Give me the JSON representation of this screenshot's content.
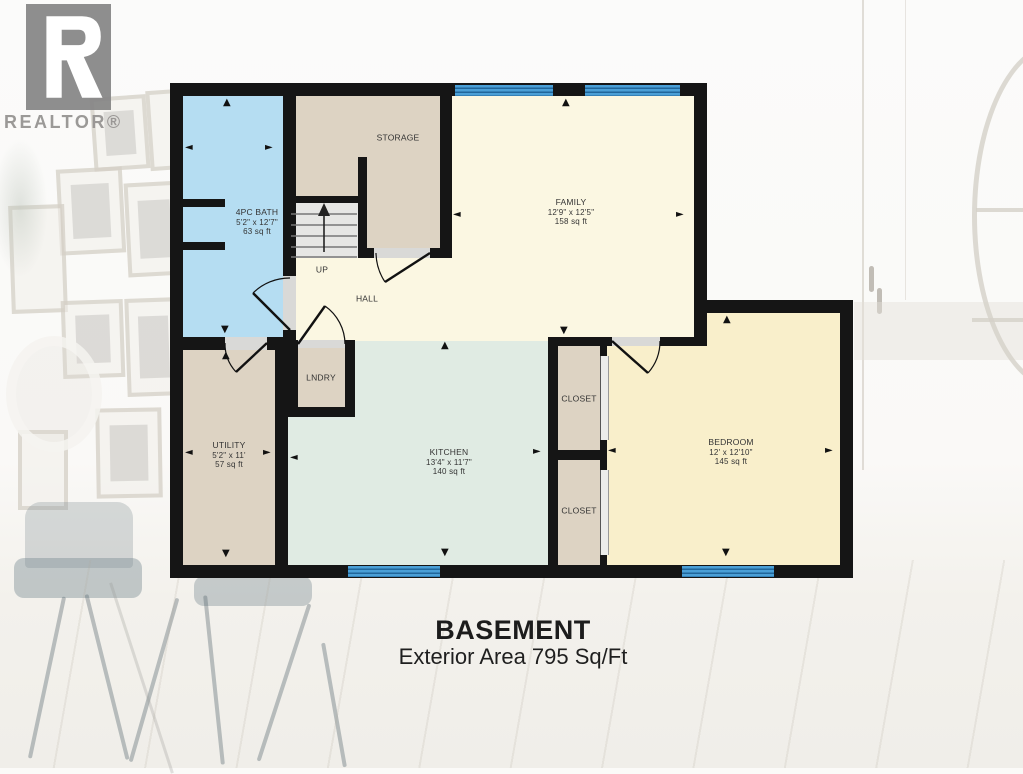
{
  "branding": {
    "logo_text": "REALTOR®"
  },
  "title": {
    "heading": "BASEMENT",
    "subheading": "Exterior Area 795 Sq/Ft"
  },
  "rooms": {
    "bath": {
      "name": "4PC BATH",
      "dims": "5'2\" x 12'7\"",
      "area": "63 sq ft"
    },
    "storage": {
      "name": "STORAGE"
    },
    "family": {
      "name": "FAMILY",
      "dims": "12'9\" x 12'5\"",
      "area": "158 sq ft"
    },
    "stairs": {
      "label": "UP"
    },
    "hall": {
      "name": "HALL"
    },
    "laundry": {
      "name": "LNDRY"
    },
    "utility": {
      "name": "UTILITY",
      "dims": "5'2\" x 11'",
      "area": "57 sq ft"
    },
    "kitchen": {
      "name": "KITCHEN",
      "dims": "13'4\" x 11'7\"",
      "area": "140 sq ft"
    },
    "closet_upper": {
      "name": "CLOSET"
    },
    "closet_lower": {
      "name": "CLOSET"
    },
    "bedroom": {
      "name": "BEDROOM",
      "dims": "12' x 12'10\"",
      "area": "145 sq ft"
    }
  },
  "glyphs": {
    "up": "▲",
    "down": "▼",
    "left": "◄",
    "right": "►"
  },
  "colors": {
    "wall": "#151515",
    "bath_fill": "#b5ddf2",
    "storage_fill": "#ddd3c3",
    "living_fill": "#fbf7e2",
    "kitchen_fill": "#e0ebe3",
    "bedroom_fill": "#f9efcb",
    "stairs_fill": "#e6e6e4",
    "window_blue": "#4a9fd6",
    "window_stripe": "#20669b",
    "door_opening": "#d9d9d7"
  }
}
